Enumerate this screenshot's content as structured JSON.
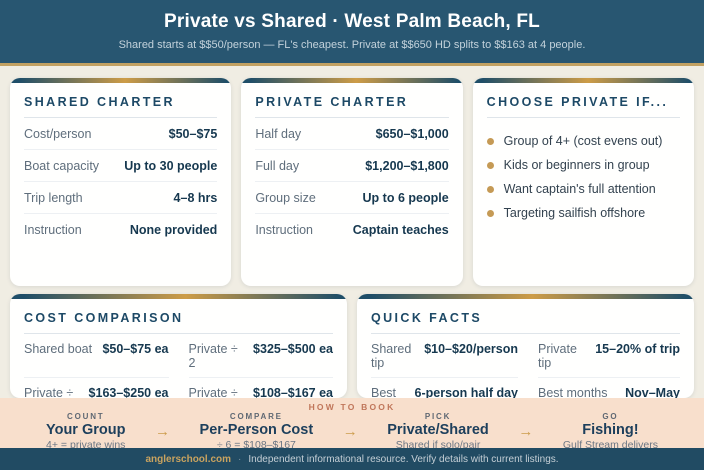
{
  "header": {
    "title": "Private vs Shared · West Palm Beach, FL",
    "subtitle": "Shared starts at $$50/person — FL's cheapest. Private at $$650 HD splits to $$163 at 4 people."
  },
  "shared_card": {
    "title": "SHARED CHARTER",
    "rows": [
      {
        "label": "Cost/person",
        "value": "$50–$75"
      },
      {
        "label": "Boat capacity",
        "value": "Up to 30 people"
      },
      {
        "label": "Trip length",
        "value": "4–8 hrs"
      },
      {
        "label": "Instruction",
        "value": "None provided"
      }
    ]
  },
  "private_card": {
    "title": "PRIVATE CHARTER",
    "rows": [
      {
        "label": "Half day",
        "value": "$650–$1,000"
      },
      {
        "label": "Full day",
        "value": "$1,200–$1,800"
      },
      {
        "label": "Group size",
        "value": "Up to 6 people"
      },
      {
        "label": "Instruction",
        "value": "Captain teaches"
      }
    ]
  },
  "choose_card": {
    "title": "CHOOSE PRIVATE IF...",
    "bullets": [
      "Group of 4+ (cost evens out)",
      "Kids or beginners in group",
      "Want captain's full attention",
      "Targeting sailfish offshore"
    ]
  },
  "cost_card": {
    "title": "COST COMPARISON",
    "pairs": [
      {
        "label": "Shared boat",
        "value": "$50–$75 ea"
      },
      {
        "label": "Private ÷ 2",
        "value": "$325–$500 ea"
      },
      {
        "label": "Private ÷ 4",
        "value": "$163–$250 ea"
      },
      {
        "label": "Private ÷ 6",
        "value": "$108–$167 ea"
      }
    ],
    "note": "Shared wins on cost. Private wins on the experience."
  },
  "quick_card": {
    "title": "QUICK FACTS",
    "pairs": [
      {
        "label": "Shared tip",
        "value": "$10–$20/person"
      },
      {
        "label": "Private tip",
        "value": "15–20% of trip"
      },
      {
        "label": "Best private",
        "value": "6-person half day"
      },
      {
        "label": "Best months",
        "value": "Nov–May"
      }
    ],
    "note": "WPB shared rates are FL's lowest — solo/pair go shared."
  },
  "how_to_book": {
    "label": "HOW TO BOOK",
    "arrow": "→",
    "steps": [
      {
        "kicker": "COUNT",
        "title": "Your Group",
        "sub": "4+ = private wins"
      },
      {
        "kicker": "COMPARE",
        "title": "Per-Person Cost",
        "sub": "÷ 6 = $108–$167"
      },
      {
        "kicker": "PICK",
        "title": "Private/Shared",
        "sub": "Shared if solo/pair"
      },
      {
        "kicker": "GO",
        "title": "Fishing!",
        "sub": "Gulf Stream delivers"
      }
    ]
  },
  "footer": {
    "brand": "anglerschool.com",
    "separator": "·",
    "text": "Independent informational resource. Verify details with current listings."
  },
  "colors": {
    "header_navy": "#285671",
    "gold_accent": "#c2a162",
    "page_background": "#f0ede3",
    "value_navy": "#16384f",
    "peach_band": "#f8dfcc",
    "terracotta_label": "#c0765a",
    "footer_navy": "#214b63"
  }
}
